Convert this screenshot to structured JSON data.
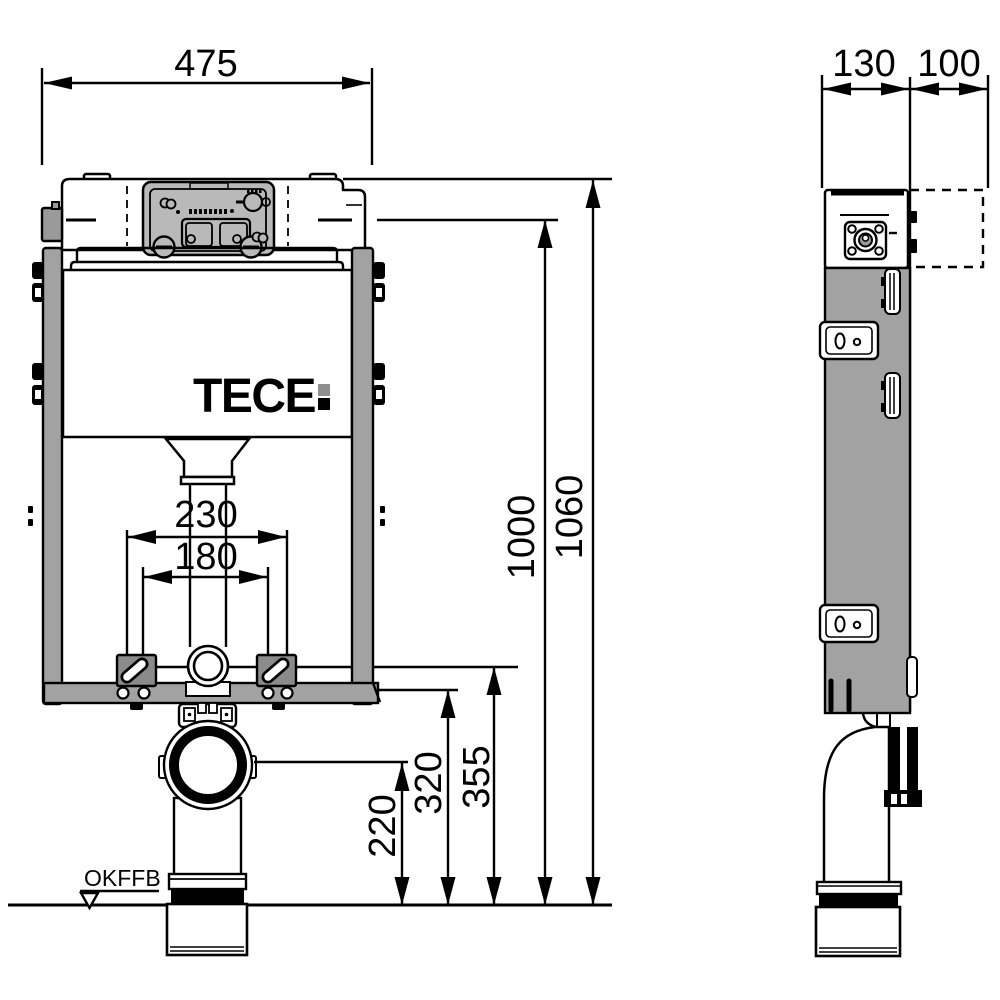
{
  "front_view": {
    "logo": "TECE",
    "floor_label": "OKFFB",
    "dims": {
      "width": "475",
      "total_height": "1060",
      "frame_height": "1000",
      "outlet_height": "220",
      "height_320": "320",
      "height_355": "355",
      "spacing_outer": "230",
      "spacing_inner": "180"
    }
  },
  "side_view": {
    "dims": {
      "depth_body": "130",
      "depth_front": "100"
    }
  },
  "colors": {
    "line": "#000000",
    "frame_gray": "#a2a2a2",
    "panel_gray": "#b9b9b9",
    "block_gray": "#8b8b8b",
    "logo_colon_top": "#8f8f8f",
    "background": "#ffffff"
  }
}
